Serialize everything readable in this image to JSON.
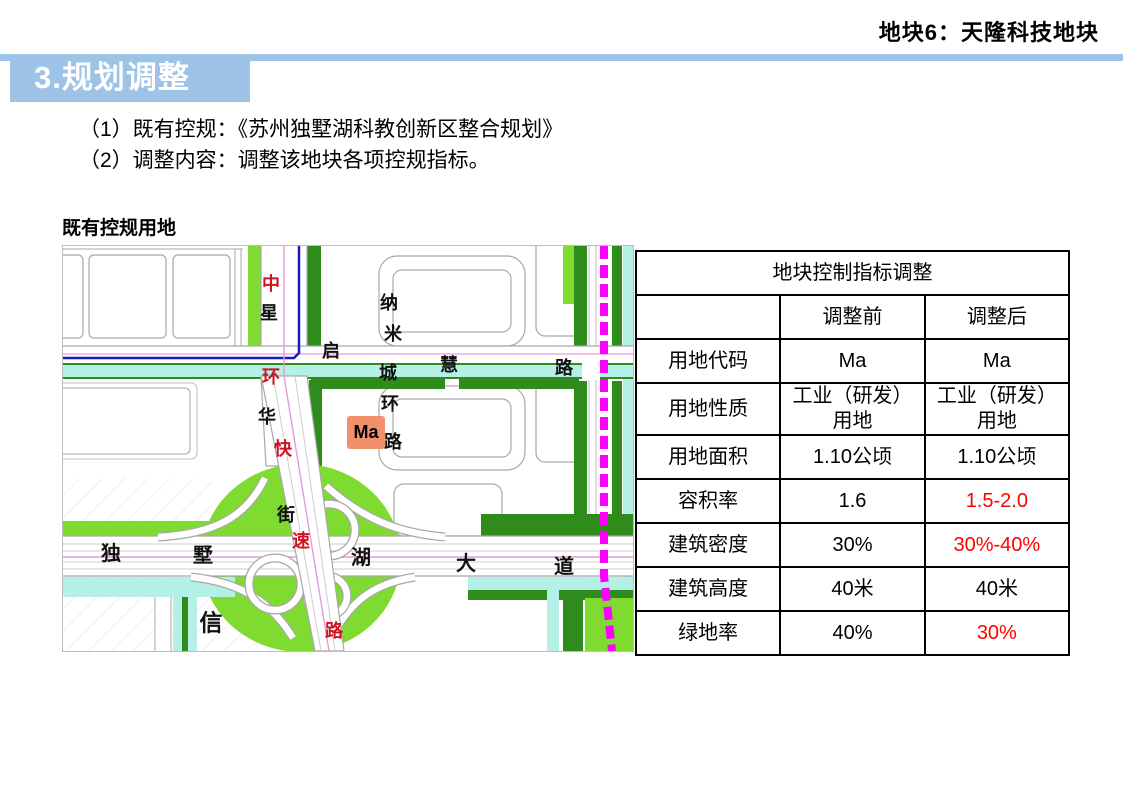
{
  "page_header": {
    "title": "地块6：天隆科技地块"
  },
  "section_banner": {
    "title": "3.规划调整"
  },
  "intro": {
    "line1": "（1）既有控规：《苏州独墅湖科教创新区整合规划》",
    "line2": "（2）调整内容：调整该地块各项控规指标。"
  },
  "map": {
    "caption": "既有控规用地",
    "parcel_label": "Ma",
    "labels": [
      {
        "text": "中",
        "x": 208,
        "y": 38,
        "color": "#cf1322"
      },
      {
        "text": "星",
        "x": 206,
        "y": 67,
        "color": "#111111"
      },
      {
        "text": "环",
        "x": 208,
        "y": 131,
        "color": "#cf1322"
      },
      {
        "text": "华",
        "x": 204,
        "y": 171,
        "color": "#111111"
      },
      {
        "text": "快",
        "x": 220,
        "y": 203,
        "color": "#cf1322"
      },
      {
        "text": "街",
        "x": 223,
        "y": 269,
        "color": "#111111"
      },
      {
        "text": "速",
        "x": 238,
        "y": 295,
        "color": "#cf1322"
      },
      {
        "text": "路",
        "x": 271,
        "y": 385,
        "color": "#cf1322"
      },
      {
        "text": "纳",
        "x": 326,
        "y": 57,
        "color": "#111111"
      },
      {
        "text": "米",
        "x": 330,
        "y": 88,
        "color": "#111111"
      },
      {
        "text": "城",
        "x": 325,
        "y": 127,
        "color": "#111111"
      },
      {
        "text": "环",
        "x": 327,
        "y": 158,
        "color": "#111111"
      },
      {
        "text": "路",
        "x": 330,
        "y": 196,
        "color": "#111111"
      },
      {
        "text": "启",
        "x": 268,
        "y": 105,
        "color": "#111111"
      },
      {
        "text": "慧",
        "x": 386,
        "y": 119,
        "color": "#111111"
      },
      {
        "text": "路",
        "x": 501,
        "y": 122,
        "color": "#111111"
      },
      {
        "text": "独",
        "x": 48,
        "y": 308,
        "color": "#111111",
        "size": 20
      },
      {
        "text": "墅",
        "x": 140,
        "y": 310,
        "color": "#111111",
        "size": 20
      },
      {
        "text": "湖",
        "x": 298,
        "y": 312,
        "color": "#111111",
        "size": 20
      },
      {
        "text": "大",
        "x": 403,
        "y": 318,
        "color": "#111111",
        "size": 20
      },
      {
        "text": "道",
        "x": 501,
        "y": 321,
        "color": "#111111",
        "size": 20
      },
      {
        "text": "信",
        "x": 148,
        "y": 377,
        "color": "#111111",
        "size": 23
      }
    ],
    "colors": {
      "light_green": "#7FDB30",
      "dark_green": "#2F8C1C",
      "canal_cyan": "#B4F0E6",
      "metro_magenta": "#FF00FF",
      "boundary_blue": "#1A1AB8",
      "parcel_salmon": "#F2906C"
    }
  },
  "table": {
    "title": "地块控制指标调整",
    "columns": [
      "",
      "调整前",
      "调整后"
    ],
    "rows": [
      {
        "label": "用地代码",
        "before": "Ma",
        "after": "Ma",
        "before_changed": false,
        "after_changed": false
      },
      {
        "label": "用地性质",
        "before": "工业（研发）用地",
        "after": "工业（研发）用地",
        "before_changed": false,
        "after_changed": false
      },
      {
        "label": "用地面积",
        "before": "1.10公顷",
        "after": "1.10公顷",
        "before_changed": false,
        "after_changed": false
      },
      {
        "label": "容积率",
        "before": "1.6",
        "after": "1.5-2.0",
        "before_changed": false,
        "after_changed": true
      },
      {
        "label": "建筑密度",
        "before": "30%",
        "after": "30%-40%",
        "before_changed": false,
        "after_changed": true
      },
      {
        "label": "建筑高度",
        "before": "40米",
        "after": "40米",
        "before_changed": false,
        "after_changed": false
      },
      {
        "label": "绿地率",
        "before": "40%",
        "after": "30%",
        "before_changed": false,
        "after_changed": true
      }
    ],
    "changed_color": "#ff0000"
  }
}
